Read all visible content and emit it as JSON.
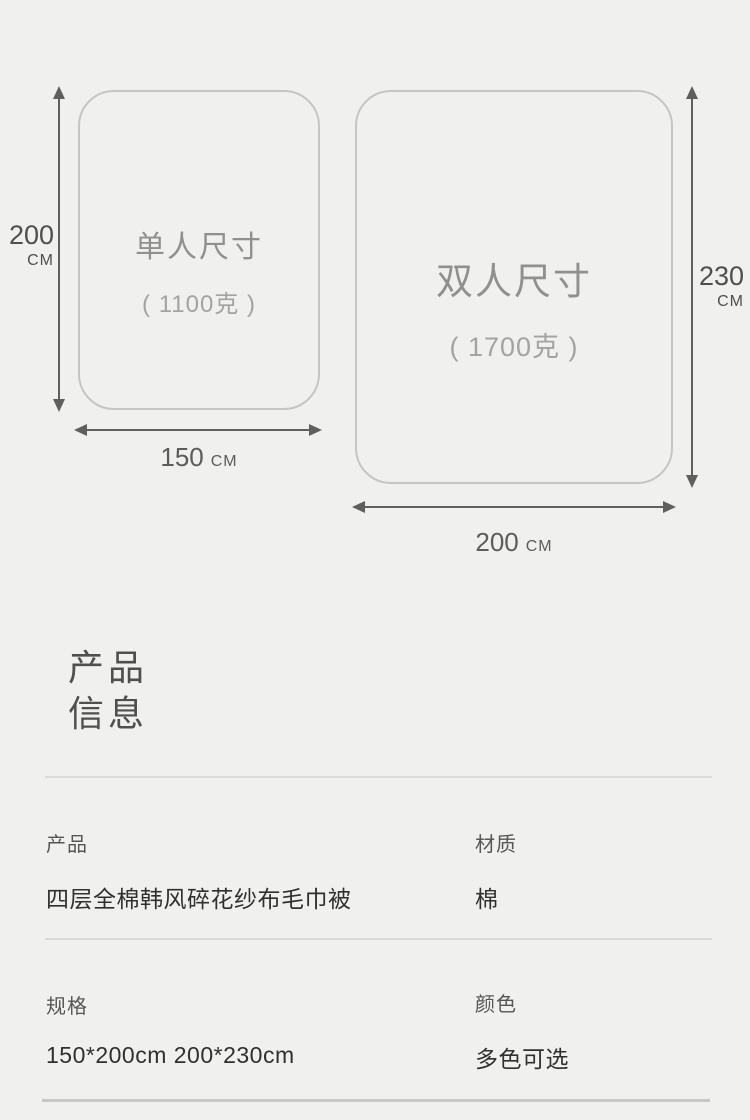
{
  "size_diagram": {
    "items": [
      {
        "name": "单人尺寸",
        "weight": "( 1100克 )",
        "height_value": "200",
        "height_unit": "CM",
        "width_value": "150",
        "width_unit": "CM"
      },
      {
        "name": "双人尺寸",
        "weight": "( 1700克 )",
        "height_value": "230",
        "height_unit": "CM",
        "width_value": "200",
        "width_unit": "CM"
      }
    ]
  },
  "product_info": {
    "heading_line1": "产品",
    "heading_line2": "信息",
    "fields": [
      {
        "label": "产品",
        "value": "四层全棉韩风碎花纱布毛巾被"
      },
      {
        "label": "材质",
        "value": "棉"
      },
      {
        "label": "规格",
        "value": "150*200cm 200*230cm"
      },
      {
        "label": "颜色",
        "value": "多色可选"
      }
    ]
  },
  "colors": {
    "background": "#f0f0ee",
    "box_border": "#c5c5c3",
    "box_title_text": "#909090",
    "box_weight_text": "#a3a3a3",
    "arrow": "#5f5f5f",
    "dimension_label_text": "#4f4f4f",
    "heading_text": "#4f4f4f",
    "field_label_text": "#565656",
    "field_value_text": "#303030",
    "divider": "#dadad8",
    "thick_divider": "#c7c7c7"
  }
}
